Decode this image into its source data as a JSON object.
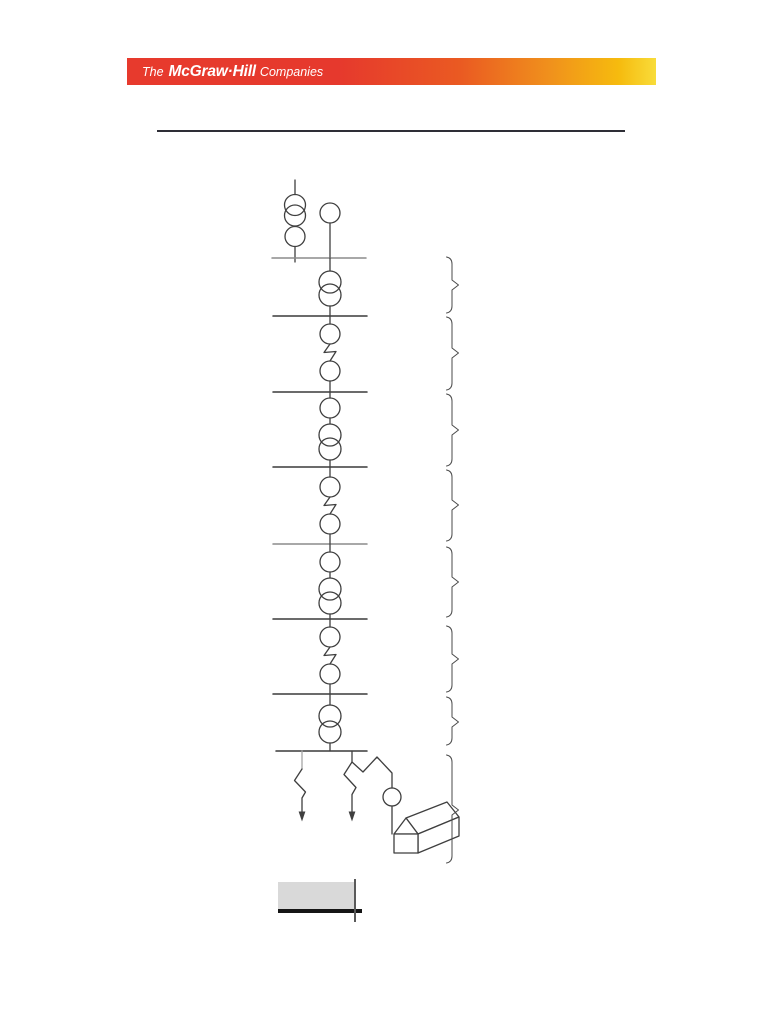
{
  "banner": {
    "logo_prefix": "The",
    "logo_brand": "McGraw·Hill",
    "logo_suffix": "Companies",
    "text_color": "#ffffff",
    "gradient": [
      "#e73a2d",
      "#ea5a22",
      "#f6bb0e",
      "#f8dc3a"
    ]
  },
  "title_rule": {
    "color": "#2e2e36"
  },
  "diagram": {
    "kind": "electric-power-system-one-line-diagram",
    "stroke_color": "#3f3f3f",
    "bus_count": 8,
    "section_brace_count": 8,
    "load_arrow_count": 2,
    "symbols": {
      "generator": "circle",
      "transformer": "two-overlapping-circles",
      "bus": "horizontal-line",
      "circuit_breaker": "circle",
      "line_section": "zigzag",
      "load": "zigzag-with-down-arrow",
      "meter": "small-circle",
      "customer": "house-3d"
    }
  },
  "footer_box": {
    "fill": "#d9d9d9",
    "rule_color": "#151515"
  }
}
